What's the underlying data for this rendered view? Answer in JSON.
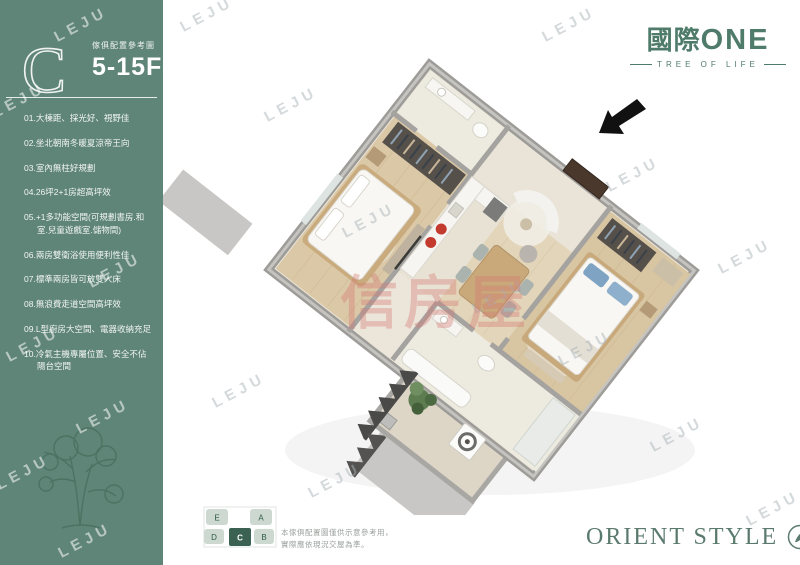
{
  "header": {
    "unit_letter": "C",
    "subtitle": "傢俱配置參考圖",
    "floors": "5-15F"
  },
  "features": [
    "01.大棟距、採光好、視野佳",
    "02.坐北朝南冬暖夏涼帝王向",
    "03.室內無柱好規劃",
    "04.26坪2+1房超高坪效",
    "05.+1多功能空間(可規劃書房.和室.兒童遊戲室.儲物間)",
    "06.兩房雙衛浴使用便利性佳",
    "07.標準兩房皆可放雙人床",
    "08.無浪費走道空間高坪效",
    "09.L型廚房大空間、電器收納充足",
    "10.冷氣主機專屬位置、安全不佔陽台空間"
  ],
  "logo": {
    "brand_cjk": "國際",
    "brand_en": "ONE",
    "tagline": "TREE OF LIFE"
  },
  "keyplan": {
    "units": [
      "E",
      "A",
      "D",
      "C",
      "B"
    ],
    "highlighted": "C",
    "disclaimer_line1": "本傢俱配置圖僅供示意參考用，",
    "disclaimer_line2": "實際應依現況交屋為準。"
  },
  "footer": {
    "brand": "ORIENT STYLE"
  },
  "watermark": {
    "text": "LEJU",
    "center": "信房屋"
  },
  "colors": {
    "sidebar_green": "#5f8478",
    "logo_green": "#4f7b6b",
    "keyplan_highlight": "#3a6152",
    "center_watermark_pink": "#d67873",
    "entry_arrow": "#111111"
  }
}
